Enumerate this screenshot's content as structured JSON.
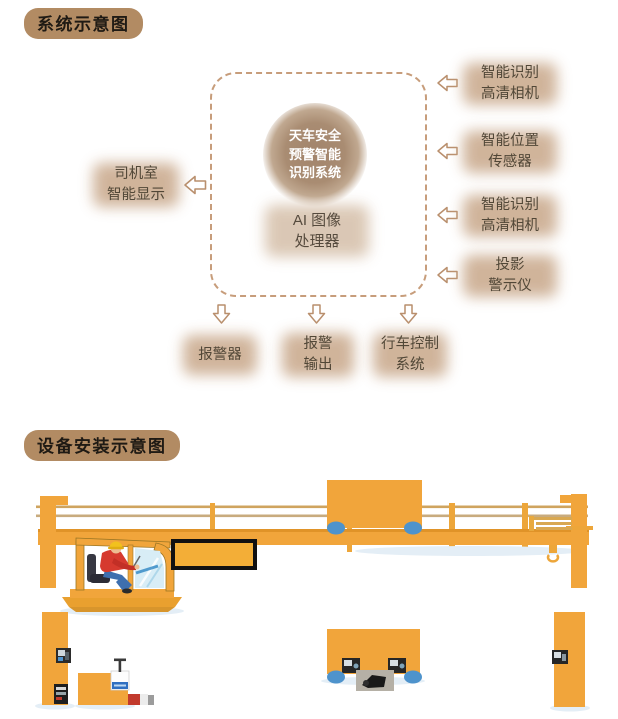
{
  "system_diagram": {
    "title": "系统示意图",
    "hub": {
      "label": "天车安全\n预警智能\n识别系统"
    },
    "processor": {
      "label": "AI 图像\n处理器"
    },
    "left_item": {
      "label": "司机室\n智能显示"
    },
    "right_items": [
      {
        "label": "智能识别\n高清相机"
      },
      {
        "label": "智能位置\n传感器"
      },
      {
        "label": "智能识别\n高清相机"
      },
      {
        "label": "投影\n警示仪"
      }
    ],
    "output_items": [
      {
        "label": "报警器"
      },
      {
        "label": "报警\n输出"
      },
      {
        "label": "行车控制\n系统"
      }
    ]
  },
  "installation_diagram": {
    "title": "设备安装示意图"
  },
  "icons": [
    {
      "name": "arrow-left-icon",
      "glyph": "⇦",
      "meaning": "input into system"
    },
    {
      "name": "arrow-down-icon",
      "glyph": "⇩",
      "meaning": "output from system"
    }
  ],
  "colors": {
    "title_badge": "#b28b63",
    "label_glow": "#cbac90",
    "hub_circle": "#a5886e",
    "hub_text": "#ffffff",
    "dashed_border": "#c79d7b",
    "arrow_outline": "#b98f6d",
    "crane_yellow": "#f1a53b",
    "wheel_blue": "#4e93cc",
    "screen_border": "#111111",
    "cabin_window_blue": "#d8edf6",
    "operator_shirt_red": "#d63a2f",
    "label_text": "#514737"
  }
}
